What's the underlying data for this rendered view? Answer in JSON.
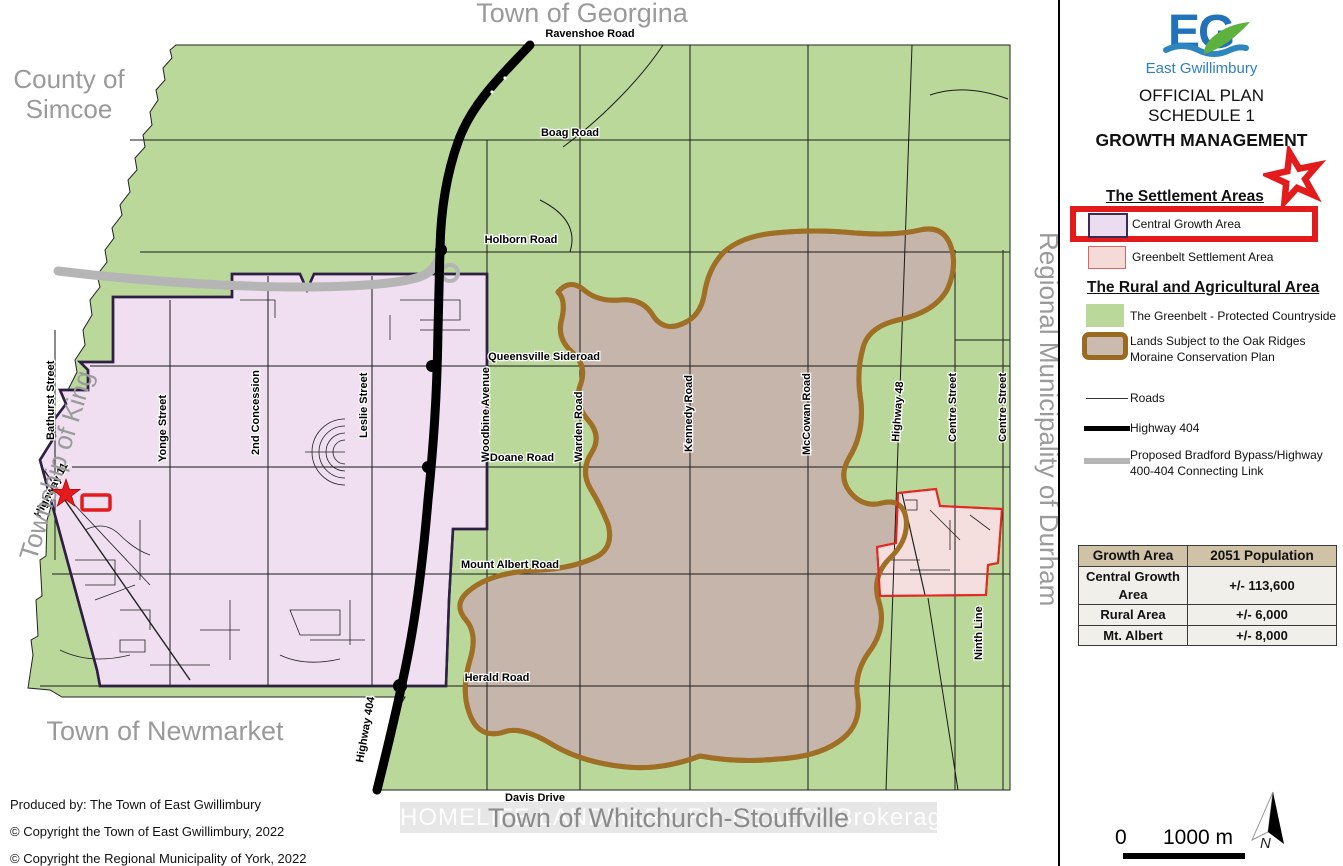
{
  "map": {
    "outer_labels": {
      "georgina": "Town of Georgina",
      "simcoe_lines": [
        "County of",
        "Simcoe"
      ],
      "king": "Township of King",
      "durham": "Regional Municipality of Durham",
      "newmarket": "Town of Newmarket",
      "whitchurch": "Town of Whitchurch-Stouffville"
    },
    "road_labels": [
      {
        "t": "Ravenshoe Road"
      },
      {
        "t": "Boag Road"
      },
      {
        "t": "Holborn Road"
      },
      {
        "t": "Queensville Sideroad"
      },
      {
        "t": "Doane Road"
      },
      {
        "t": "Mount Albert Road"
      },
      {
        "t": "Herald Road"
      },
      {
        "t": "Davis Drive"
      },
      {
        "t": "Bathurst Street"
      },
      {
        "t": "Yonge Street"
      },
      {
        "t": "2nd Concession"
      },
      {
        "t": "Leslie Street"
      },
      {
        "t": "Woodbine Avenue"
      },
      {
        "t": "Warden Road"
      },
      {
        "t": "Kennedy Road"
      },
      {
        "t": "McCowan Road"
      },
      {
        "t": "Highway 48"
      },
      {
        "t": "Centre Street"
      },
      {
        "t": "Centre Street"
      },
      {
        "t": "Ninth Line"
      },
      {
        "t": "Highway 404"
      },
      {
        "t": "Highway 11"
      }
    ]
  },
  "panel": {
    "logo": {
      "monogram": "EG",
      "municipality": "East Gwillimbury"
    },
    "title_lines": [
      "OFFICIAL PLAN",
      "SCHEDULE 1"
    ],
    "subtitle": "GROWTH MANAGEMENT",
    "settlement": {
      "heading": "The Settlement Areas",
      "items": [
        {
          "label": "Central Growth Area"
        },
        {
          "label": "Greenbelt Settlement Area"
        }
      ]
    },
    "rural": {
      "heading": "The Rural and Agricultural Area",
      "items": [
        {
          "label": "The Greenbelt - Protected Countryside"
        },
        {
          "lines": [
            "Lands Subject to the Oak Ridges",
            "Moraine Conservation Plan"
          ]
        }
      ]
    },
    "lines": [
      {
        "label": "Roads"
      },
      {
        "label": "Highway 404"
      },
      {
        "lines": [
          "Proposed Bradford Bypass/Highway",
          "400-404 Connecting Link"
        ]
      }
    ]
  },
  "table": {
    "headers": [
      "Growth Area",
      "2051 Population"
    ],
    "rows": [
      [
        "Central Growth Area",
        "+/- 113,600"
      ],
      [
        "Rural Area",
        "+/- 6,000"
      ],
      [
        "Mt. Albert",
        "+/- 8,000"
      ]
    ]
  },
  "scale_bar": {
    "zero": "0",
    "distance": "1000 m"
  },
  "north_label": "N",
  "credits": [
    "Produced by: The Town of East Gwillimbury",
    "© Copyright the Town of East Gwillimbury, 2022",
    "© Copyright the Regional Municipality of York, 2022"
  ],
  "watermark": "HOMELIFE LANDMARK RH REALTY Brokerage",
  "colors": {
    "greenbelt": "#b9d89a",
    "central_growth_area": "#efdff0",
    "central_growth_border": "#2f1f45",
    "moraine_fill": "#c6b5ab",
    "moraine_border": "#a06f26",
    "greenbelt_settlement": "#f5dbd8",
    "highlight_red": "#e31b1c",
    "highway": "#000000",
    "proposed_link": "#b5b5b5",
    "logo_blue": "#2272b9",
    "logo_green": "#5cb23c"
  }
}
